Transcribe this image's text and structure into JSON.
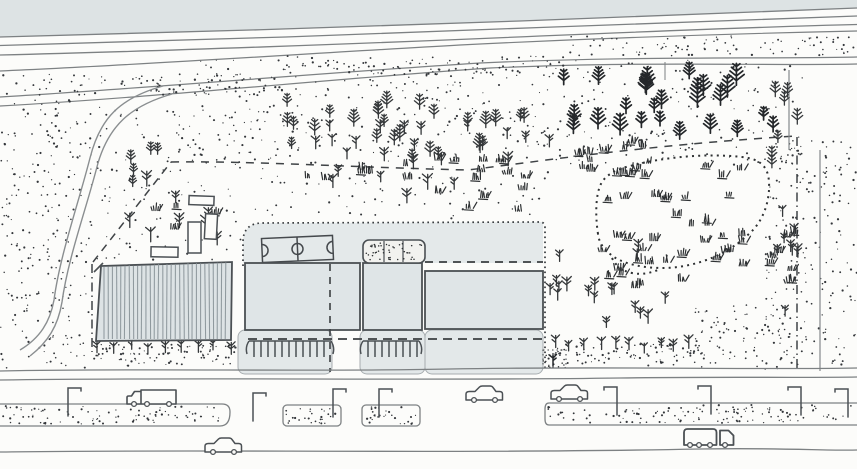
{
  "meta": {
    "title": "Hand-drawn site plan sketch",
    "description": "Aerial sketch: highway at top, wooded stippled slope with pines, campus buildings with sports court and courtyard, striped greenhouse building, stitched meadow, sapling rows, parking combs, boulevard with street lamps, cars and trucks at bottom."
  },
  "palette": {
    "paper": "#fcfcfa",
    "top_band": "#dde3e4",
    "campus": "#e4e9ea",
    "building": "#dfe5e7",
    "apron": "#e3e8e9",
    "stripe_fill": "#dde3e5",
    "stripe_line": "#8f999e",
    "road_line": "#7d8183",
    "outline": "#4b5054",
    "ink": "#2c2f31",
    "boundary": "#3f4346",
    "dot": "#33363a",
    "tree_dark": "#24272a",
    "tree": "#35383a",
    "grass": "#2e3133"
  },
  "scene": {
    "labels": [
      {
        "id": "top-road",
        "label": "highway with lane lines"
      },
      {
        "id": "upper-path",
        "label": "diagonal embankment path"
      },
      {
        "id": "curved-road",
        "label": "curving access road"
      },
      {
        "id": "site-boundary",
        "label": "dashed property boundary"
      },
      {
        "id": "meadow",
        "label": "stitched-border meadow with grass tufts"
      },
      {
        "id": "outbuildings",
        "label": "four small outbuildings"
      },
      {
        "id": "campus",
        "label": "campus with three buildings, sports court, stippled courtyard, parking combs"
      },
      {
        "id": "striped-building",
        "label": "striped greenhouse building"
      },
      {
        "id": "boulevard",
        "label": "bottom boulevard with medians, lamps and vehicles"
      }
    ]
  },
  "street": {
    "lamps": [
      {
        "x": 68,
        "y": 388,
        "dir": 1
      },
      {
        "x": 253,
        "y": 393,
        "dir": 1
      },
      {
        "x": 333,
        "y": 389,
        "dir": 1
      },
      {
        "x": 379,
        "y": 389,
        "dir": 1
      },
      {
        "x": 617,
        "y": 387,
        "dir": -1
      },
      {
        "x": 711,
        "y": 386,
        "dir": -1
      },
      {
        "x": 801,
        "y": 387,
        "dir": -1
      },
      {
        "x": 848,
        "y": 389,
        "dir": -1
      }
    ],
    "vehicles": [
      {
        "type": "truck",
        "x": 127,
        "y": 389
      },
      {
        "type": "car",
        "x": 205,
        "y": 438
      },
      {
        "type": "car",
        "x": 466,
        "y": 386
      },
      {
        "type": "car",
        "x": 551,
        "y": 385
      },
      {
        "type": "van",
        "x": 684,
        "y": 429
      }
    ]
  },
  "procedural": {
    "seed": 7,
    "stipple": [
      {
        "x": 0,
        "y": 74,
        "w": 285,
        "h": 21,
        "n": 95
      },
      {
        "x": 285,
        "y": 56,
        "w": 285,
        "h": 19,
        "n": 85
      },
      {
        "x": 570,
        "y": 36,
        "w": 287,
        "h": 20,
        "n": 90
      },
      {
        "x": 0,
        "y": 100,
        "w": 92,
        "h": 268,
        "n": 240
      },
      {
        "x": 95,
        "y": 105,
        "w": 200,
        "h": 155,
        "n": 150
      },
      {
        "x": 175,
        "y": 60,
        "w": 630,
        "h": 105,
        "n": 400
      },
      {
        "x": 765,
        "y": 140,
        "w": 92,
        "h": 230,
        "n": 190
      },
      {
        "x": 300,
        "y": 165,
        "w": 250,
        "h": 55,
        "n": 55
      },
      {
        "x": 90,
        "y": 344,
        "w": 148,
        "h": 22,
        "n": 90
      },
      {
        "x": 545,
        "y": 344,
        "w": 158,
        "h": 22,
        "n": 90
      },
      {
        "x": 695,
        "y": 305,
        "w": 100,
        "h": 62,
        "n": 85
      },
      {
        "x": 2,
        "y": 406,
        "w": 222,
        "h": 18,
        "n": 90
      },
      {
        "x": 286,
        "y": 407,
        "w": 51,
        "h": 17,
        "n": 28
      },
      {
        "x": 366,
        "y": 407,
        "w": 51,
        "h": 17,
        "n": 28
      },
      {
        "x": 548,
        "y": 405,
        "w": 305,
        "h": 18,
        "n": 120
      }
    ],
    "tree_clusters": [
      {
        "type": "pine",
        "x": 563,
        "y": 78,
        "w": 230,
        "h": 62,
        "n": 26,
        "smin": 13,
        "smax": 22,
        "dark": true
      },
      {
        "type": "pine",
        "x": 285,
        "y": 104,
        "w": 285,
        "h": 58,
        "n": 26,
        "smin": 11,
        "smax": 17
      },
      {
        "type": "sapling",
        "x": 300,
        "y": 130,
        "w": 255,
        "h": 40,
        "n": 14,
        "smin": 10,
        "smax": 14
      },
      {
        "type": "sapling",
        "x": 112,
        "y": 186,
        "w": 115,
        "h": 76,
        "n": 8,
        "smin": 11,
        "smax": 16
      },
      {
        "type": "sapling",
        "x": 330,
        "y": 124,
        "w": 140,
        "h": 90,
        "n": 10,
        "smin": 10,
        "smax": 15
      },
      {
        "type": "pine",
        "x": 128,
        "y": 142,
        "w": 52,
        "h": 68,
        "n": 5,
        "smin": 10,
        "smax": 14
      },
      {
        "type": "pine",
        "x": 770,
        "y": 88,
        "w": 28,
        "h": 86,
        "n": 7,
        "smin": 11,
        "smax": 16
      },
      {
        "type": "sapling",
        "x": 772,
        "y": 182,
        "w": 26,
        "h": 146,
        "n": 8,
        "smin": 9,
        "smax": 13
      },
      {
        "type": "sapling",
        "x": 548,
        "y": 252,
        "w": 122,
        "h": 80,
        "n": 18,
        "smin": 10,
        "smax": 14
      }
    ],
    "tree_rows": [
      {
        "x0": 96,
        "x1": 236,
        "y": 352,
        "step": 17,
        "smin": 9,
        "smax": 12
      },
      {
        "x0": 555,
        "x1": 695,
        "y": 350,
        "step": 15,
        "smin": 9,
        "smax": 13
      }
    ],
    "trees_explicit": [
      {
        "type": "pine",
        "x": 377,
        "y": 256,
        "s": 16
      },
      {
        "type": "pine",
        "x": 411,
        "y": 253,
        "s": 15
      },
      {
        "type": "pine",
        "x": 419,
        "y": 264,
        "s": 10
      },
      {
        "type": "sapling",
        "x": 553,
        "y": 366,
        "s": 11
      }
    ],
    "grass_clusters": [
      {
        "x": 540,
        "y": 140,
        "w": 120,
        "h": 38,
        "n": 14
      },
      {
        "x": 608,
        "y": 165,
        "w": 140,
        "h": 38,
        "n": 12
      },
      {
        "x": 600,
        "y": 232,
        "w": 150,
        "h": 34,
        "n": 14
      },
      {
        "x": 768,
        "y": 180,
        "w": 30,
        "h": 118,
        "n": 8
      },
      {
        "x": 285,
        "y": 158,
        "w": 250,
        "h": 22,
        "n": 16
      },
      {
        "x": 676,
        "y": 198,
        "w": 80,
        "h": 40,
        "n": 5
      },
      {
        "x": 600,
        "y": 262,
        "w": 95,
        "h": 26,
        "n": 8
      },
      {
        "x": 150,
        "y": 196,
        "w": 80,
        "h": 48,
        "n": 4
      },
      {
        "x": 420,
        "y": 188,
        "w": 110,
        "h": 24,
        "n": 5
      }
    ],
    "stripes": {
      "x0": 104,
      "x1": 229,
      "step": 4.2,
      "ytop": 266,
      "ybot": 339
    },
    "combs": [
      {
        "x0": 249,
        "x1": 331,
        "y": 341,
        "h": 16,
        "step": 7
      },
      {
        "x0": 363,
        "x1": 419,
        "y": 341,
        "h": 16,
        "step": 7
      }
    ],
    "courtyard_dots": {
      "x": 366,
      "y": 243,
      "w": 56,
      "h": 18,
      "n": 46
    },
    "patch": {
      "x": 543,
      "y": 350,
      "w": 23,
      "h": 18,
      "n": 14
    }
  }
}
